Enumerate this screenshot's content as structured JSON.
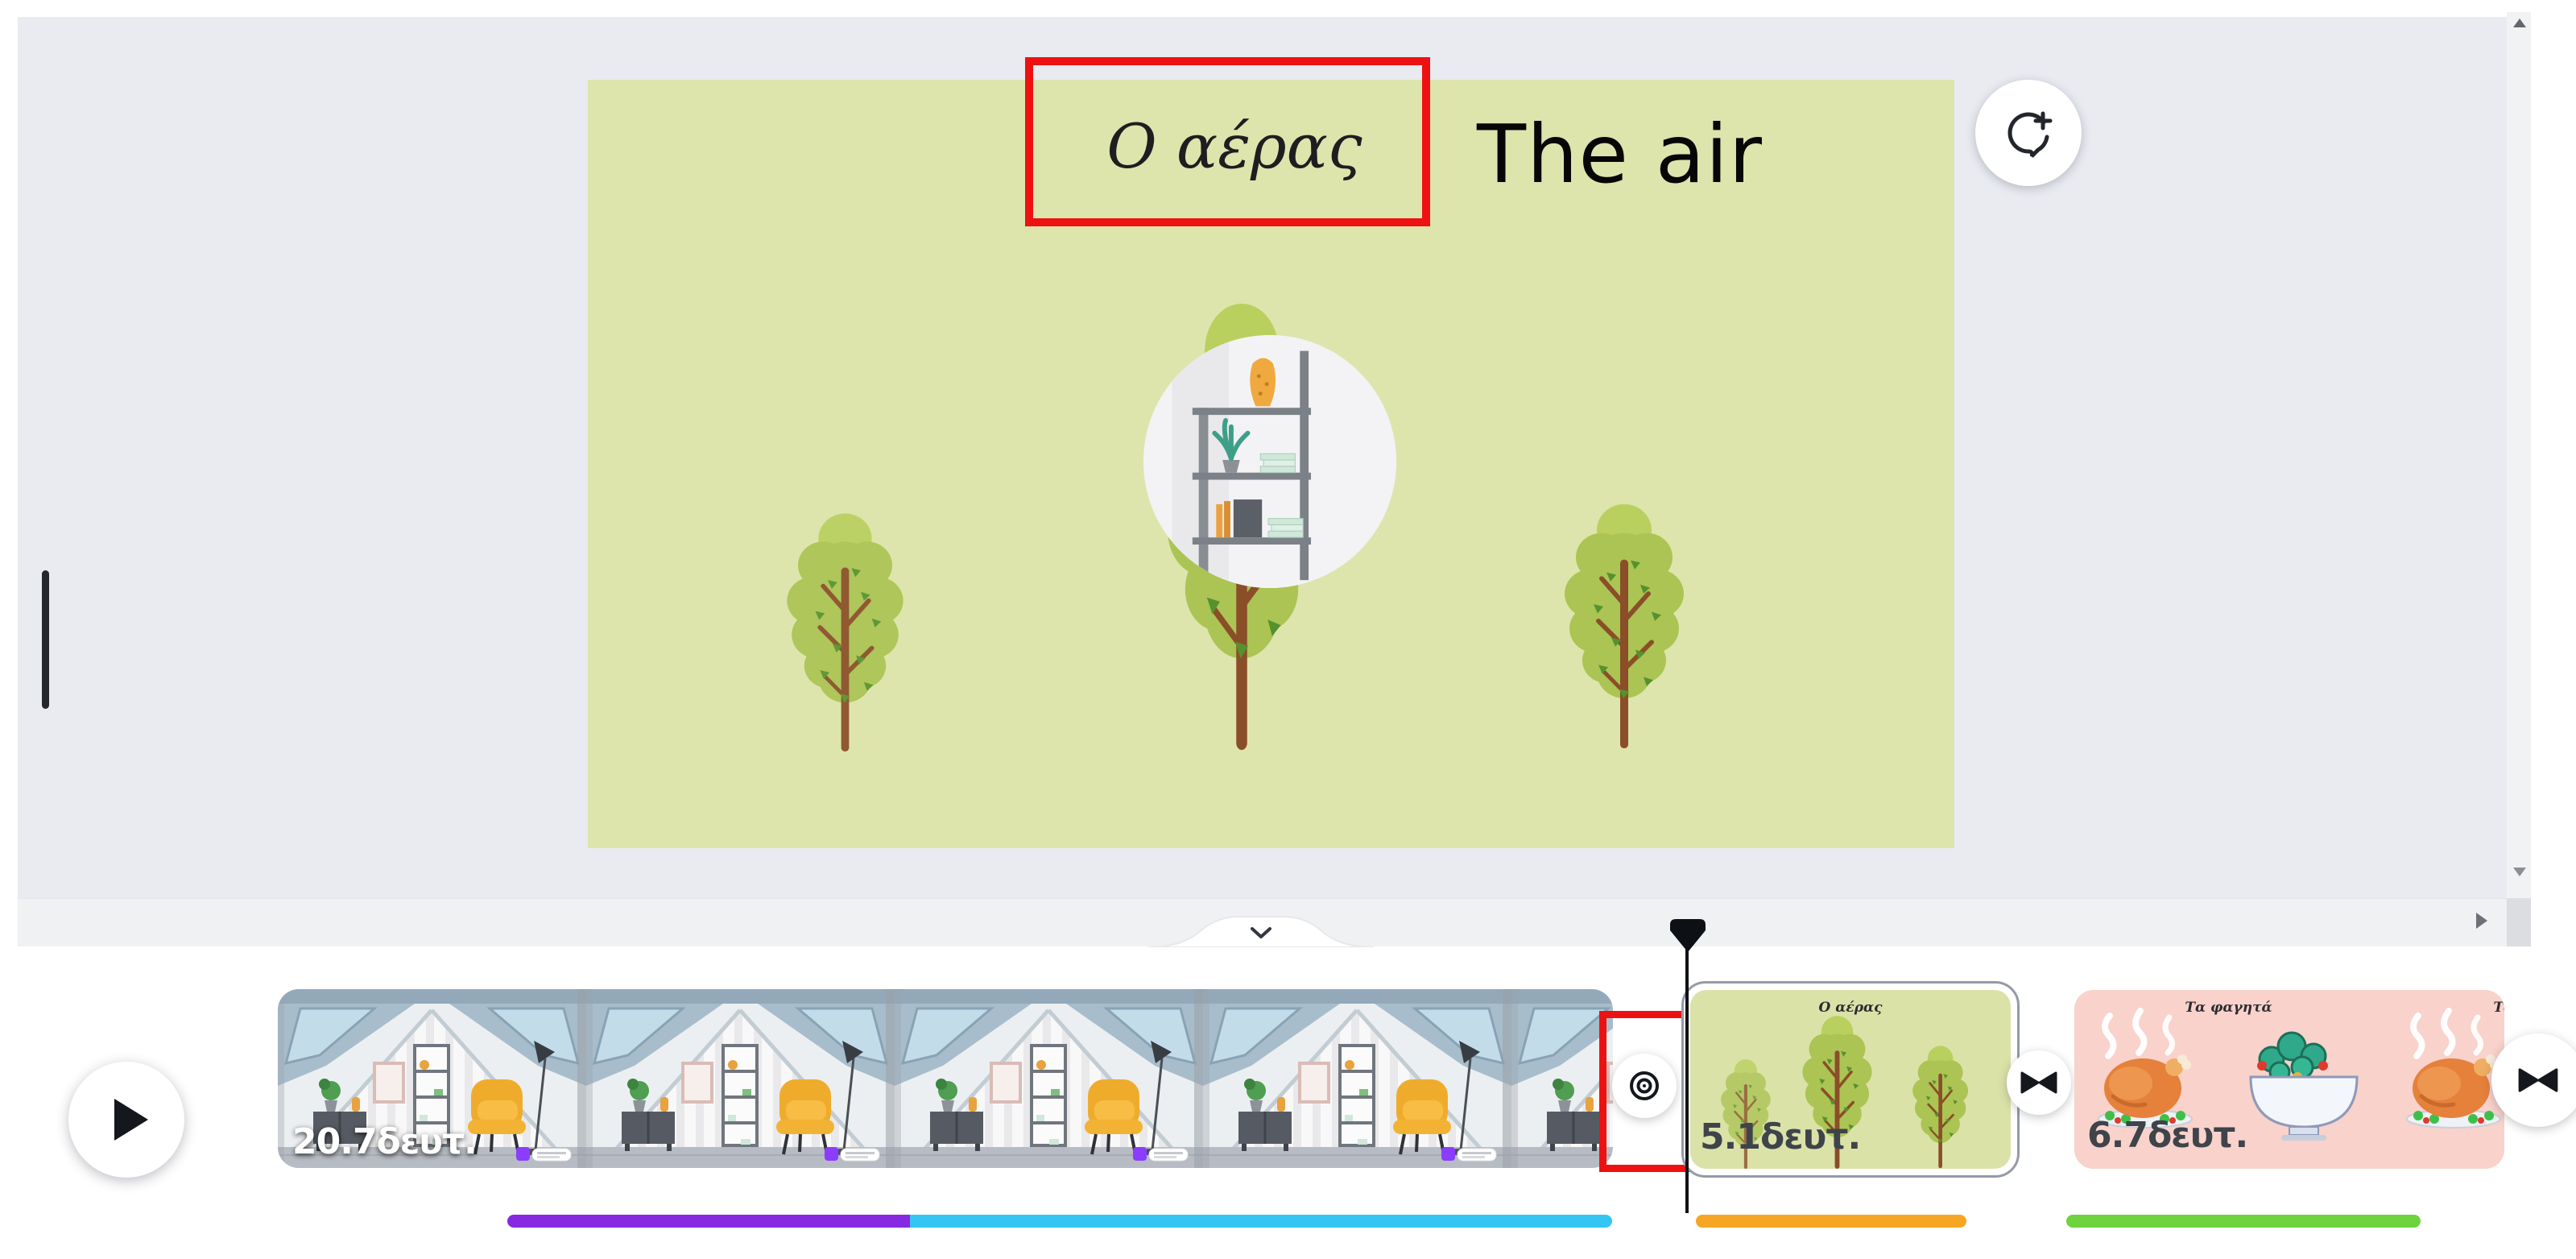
{
  "canvas": {
    "slide": {
      "title": "Ο αέρας",
      "background_color": "#dde5ad"
    },
    "translation_overlay": "The air",
    "comment_button_icon": "add-comment-icon"
  },
  "annotations": {
    "color": "#ee1111",
    "items": [
      "slide-title-box",
      "timeline-target-box"
    ]
  },
  "timeline": {
    "play_button_icon": "play-icon",
    "collapse_tab_icon": "chevron-down-icon",
    "transition_icons": [
      "transition-target-icon",
      "transition-bowtie-icon",
      "transition-bowtie-icon"
    ],
    "clips": [
      {
        "duration": "20.7δευτ."
      },
      {
        "title": "Ο αέρας",
        "duration": "5.1δευτ.",
        "selected": true
      },
      {
        "title": "Τα φαγητά",
        "duration": "6.7δευτ."
      }
    ],
    "bars": [
      {
        "color": "#8629e0"
      },
      {
        "color": "#35c5f4"
      },
      {
        "color": "#f6a623"
      },
      {
        "color": "#6ed33c"
      }
    ]
  }
}
